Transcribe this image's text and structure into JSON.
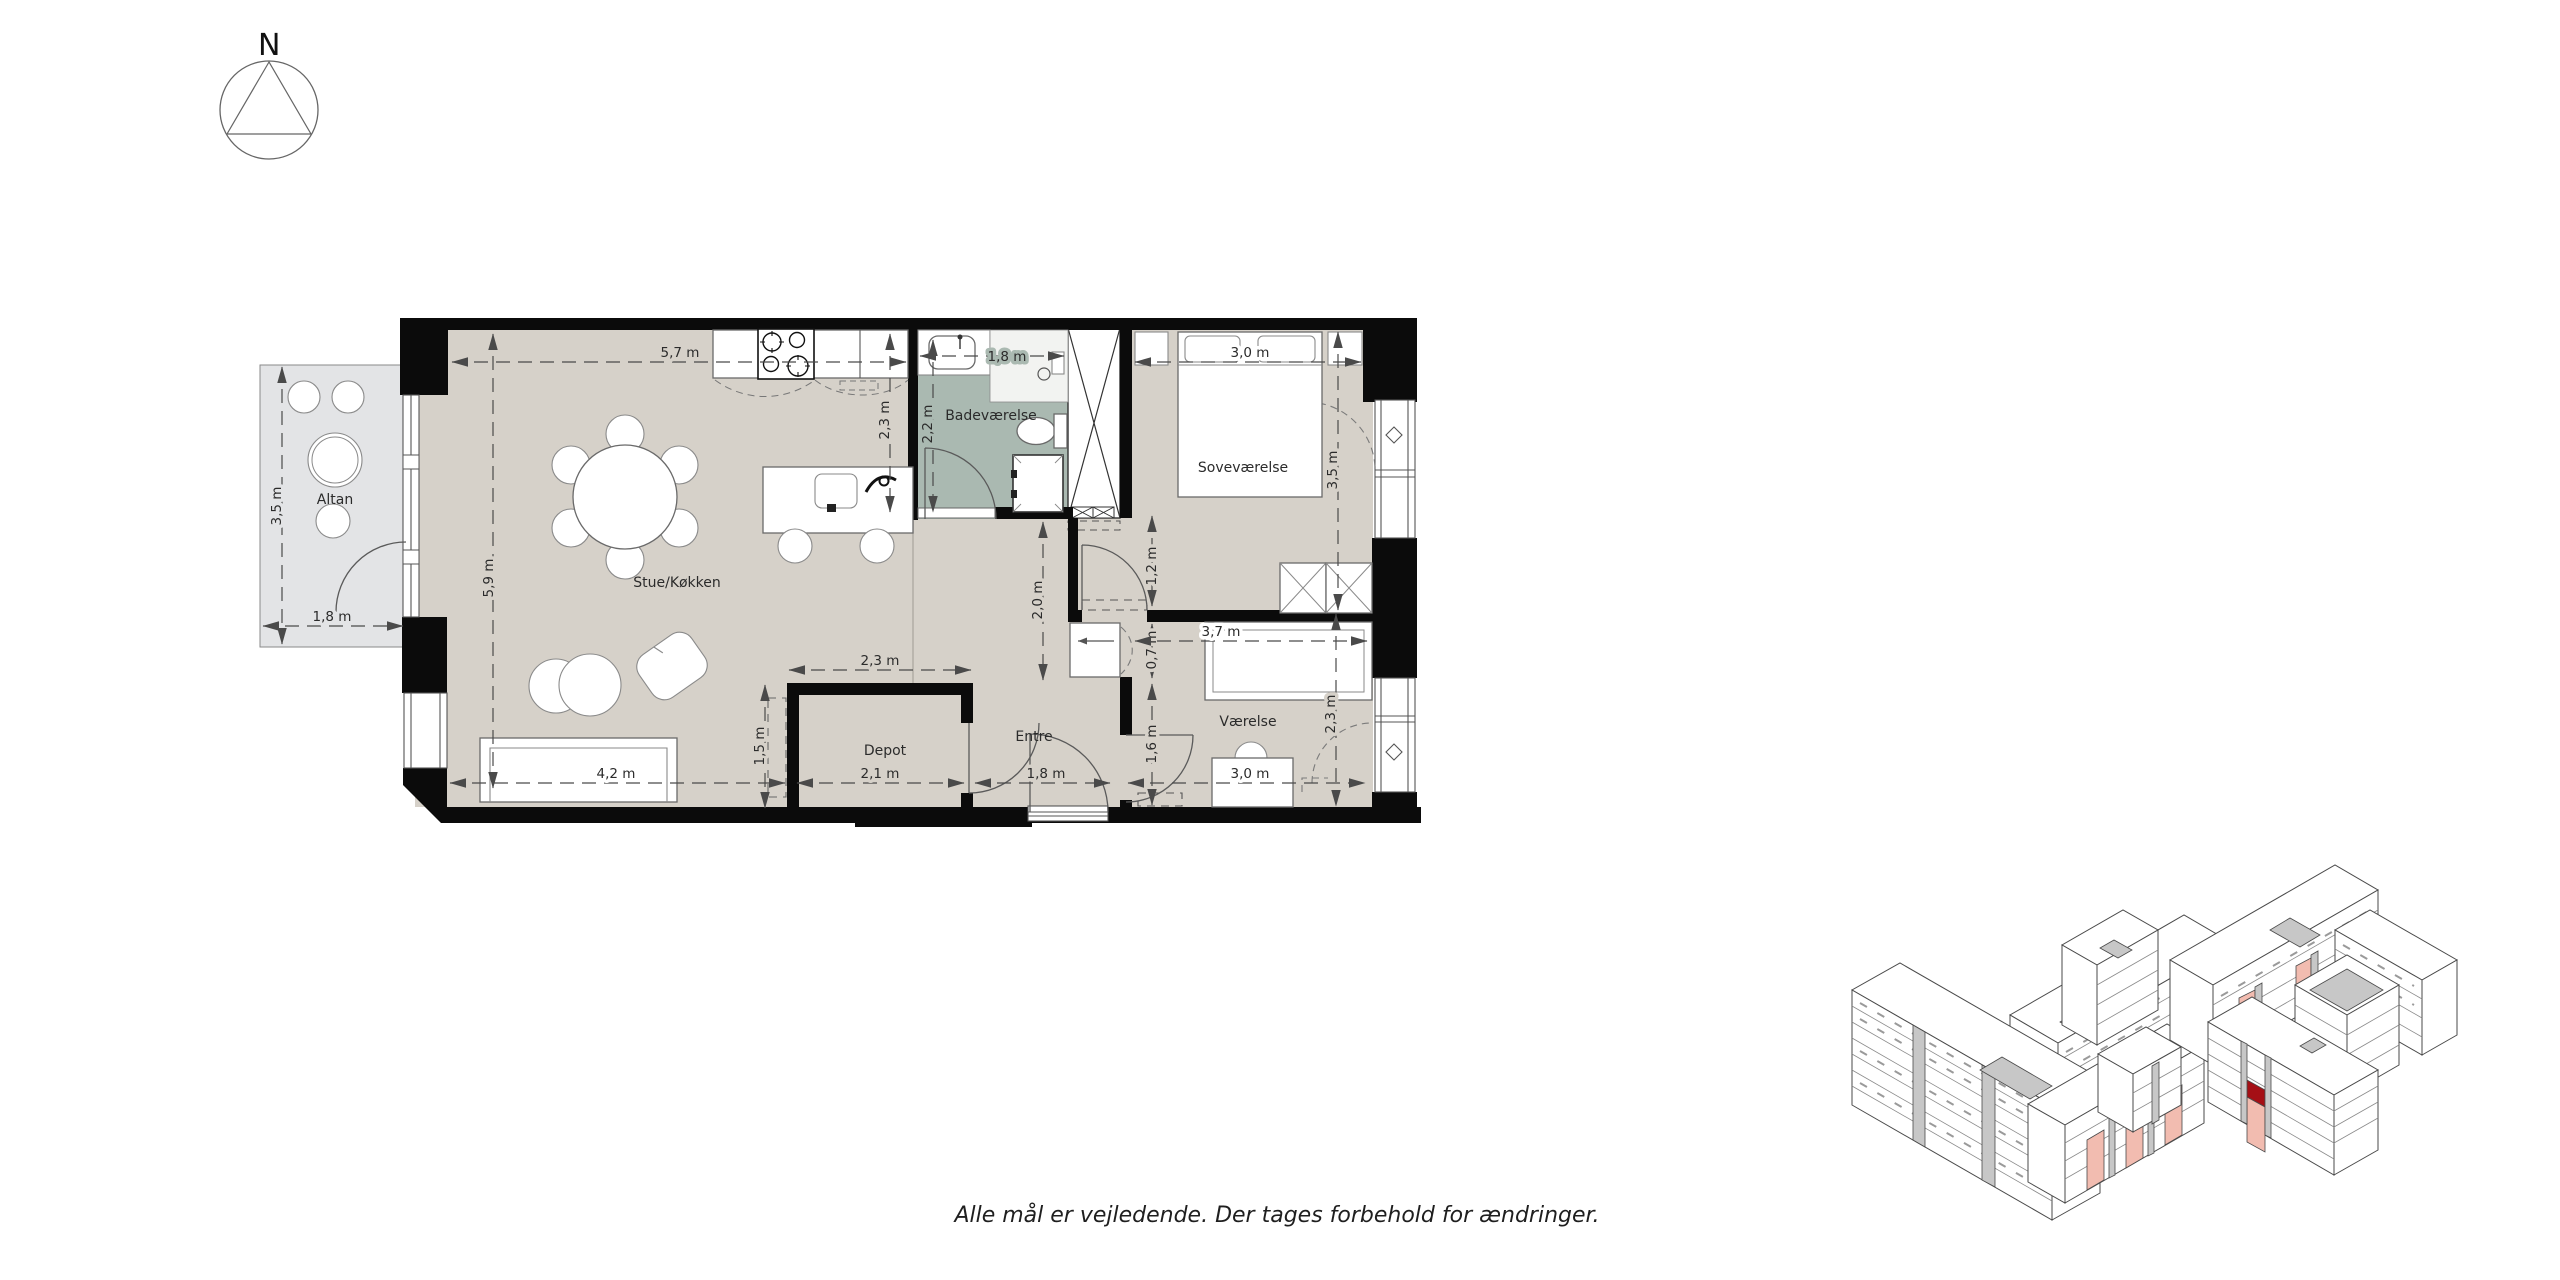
{
  "compass": {
    "label": "N"
  },
  "rooms": {
    "living": "Stue/Køkken",
    "bathroom": "Badeværelse",
    "bedroom": "Soveværelse",
    "balcony": "Altan",
    "storage": "Depot",
    "hall": "Entre",
    "room2": "Værelse"
  },
  "dims": {
    "kitchen_w": "5,7 m",
    "living_d": "5,9 m",
    "kitchen_d": "2,3 m",
    "bath_w": "1,8 m",
    "bath_d": "2,2 m",
    "bed_w": "3,0 m",
    "bed_d": "3,5 m",
    "bed_door": "1,2 m",
    "hall_d": "2,0 m",
    "closet_w": "0,7 m",
    "room2_w": "3,7 m",
    "room2_door": "1,6 m",
    "room2_w2": "3,0 m",
    "room2_d": "2,3 m",
    "depot_w": "2,3 m",
    "depot_d": "1,5 m",
    "depot_w2": "2,1 m",
    "hall_w": "1,8 m",
    "sofa_w": "4,2 m",
    "balcony_d": "3,5 m",
    "balcony_w": "1,8 m"
  },
  "footer": {
    "disclaimer": "Alle mål er vejledende. Der tages forbehold for ændringer."
  },
  "colors": {
    "floor": "#d6d1c9",
    "bathroom_floor": "#aab9b1",
    "balcony_floor": "#e3e4e6",
    "wall": "#0b0b0b",
    "highlight_unit": "#f2bcb0",
    "selected_unit": "#a50f15",
    "roof_gray": "#c7c7c7"
  }
}
